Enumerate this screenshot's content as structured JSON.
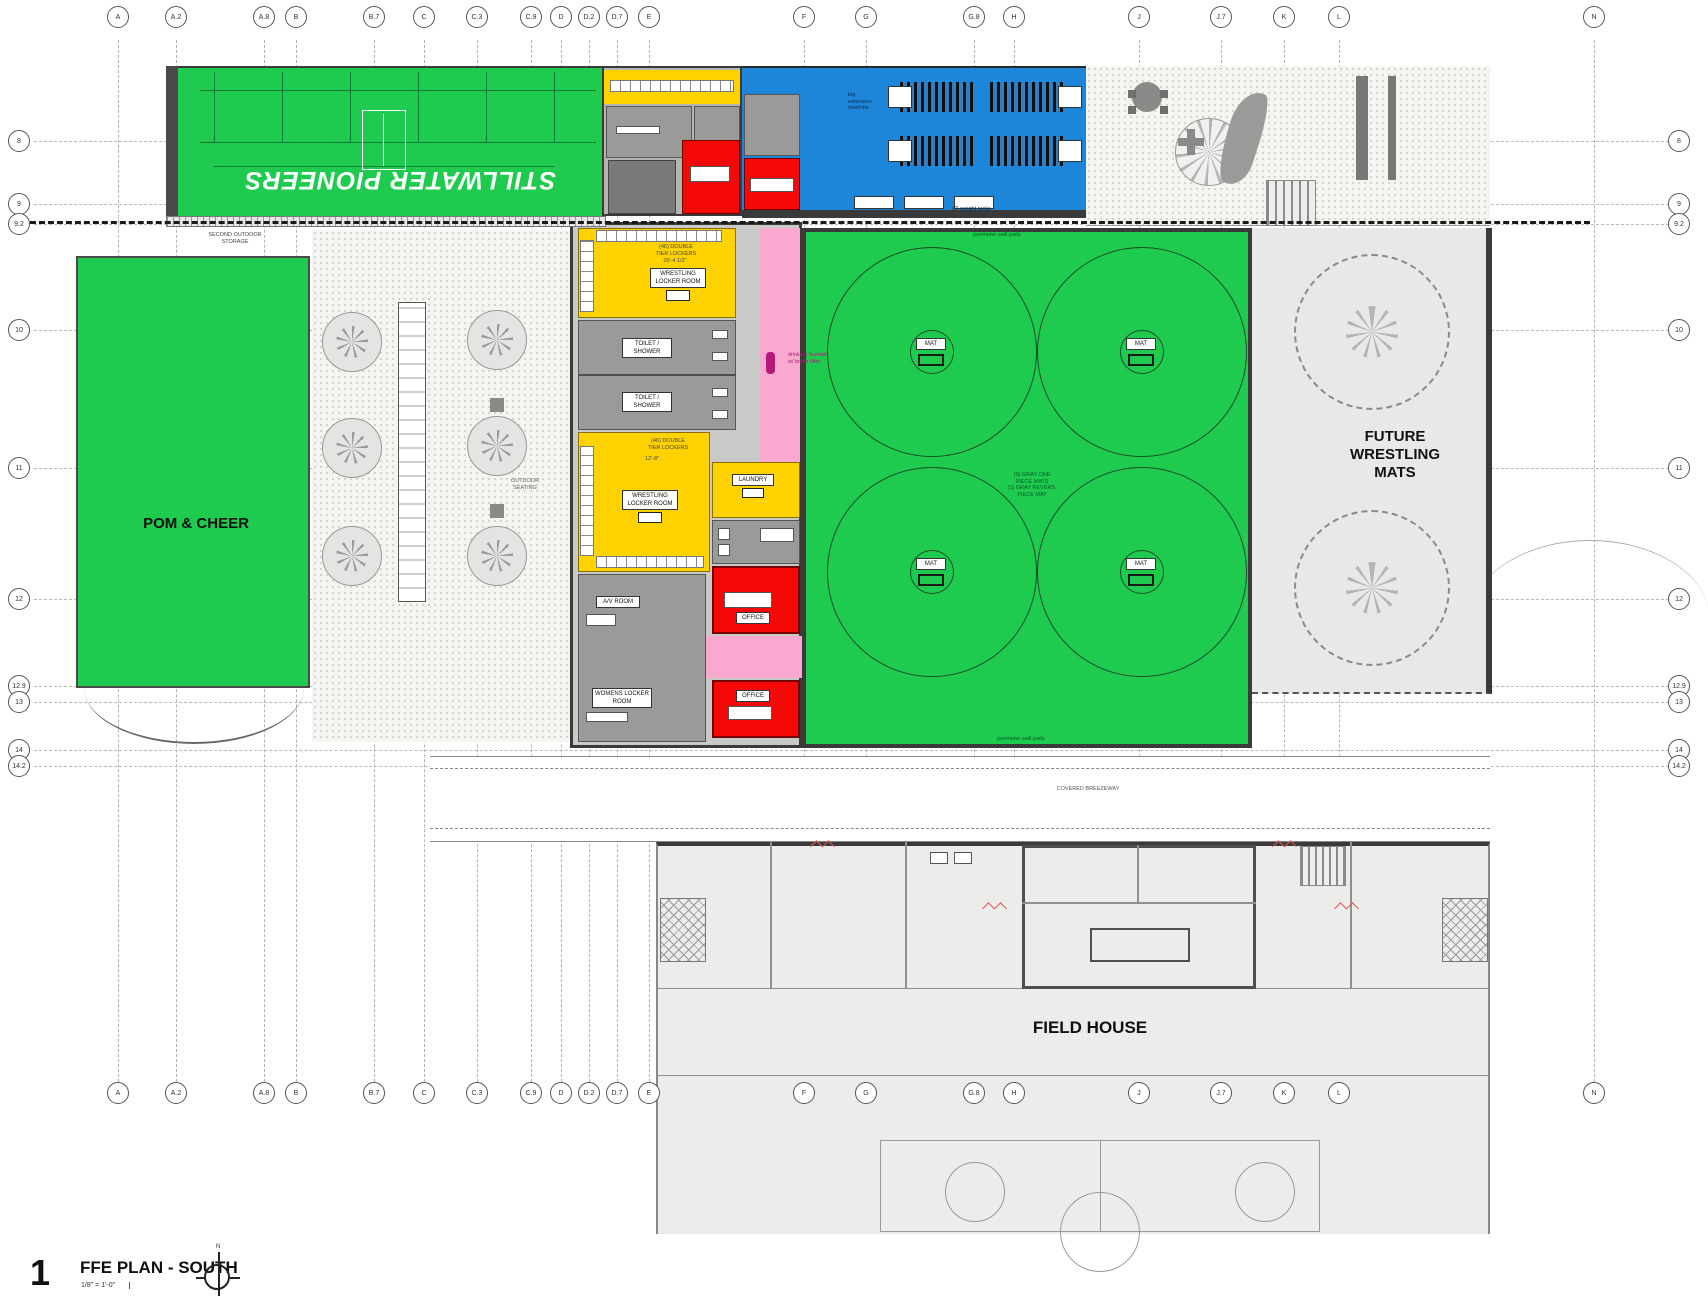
{
  "title_block": {
    "number": "1",
    "title": "FFE PLAN - SOUTH",
    "scale": "1/8\" = 1'-0\"",
    "north": "N"
  },
  "colors": {
    "green": "#1ECB4F",
    "blue": "#1E86D8",
    "yellow": "#FFD200",
    "red": "#F40808",
    "pink": "#F9A8D0",
    "gray_room": "#9A9A98",
    "light_gray": "#ECECEA",
    "wall": "#3A3A3A",
    "court_line": "#0B7A33"
  },
  "grid": {
    "columns": [
      [
        "A",
        118
      ],
      [
        "A.2",
        176
      ],
      [
        "A.8",
        264
      ],
      [
        "B",
        296
      ],
      [
        "B.7",
        374
      ],
      [
        "C",
        424
      ],
      [
        "C.3",
        477
      ],
      [
        "C.9",
        531
      ],
      [
        "D",
        561
      ],
      [
        "D.2",
        589
      ],
      [
        "D.7",
        617
      ],
      [
        "E",
        649
      ],
      [
        "F",
        804
      ],
      [
        "G",
        866
      ],
      [
        "G.8",
        974
      ],
      [
        "H",
        1014
      ],
      [
        "J",
        1139
      ],
      [
        "J.7",
        1221
      ],
      [
        "K",
        1284
      ],
      [
        "L",
        1339
      ],
      [
        "N",
        1594
      ]
    ],
    "rows": [
      [
        "8",
        141
      ],
      [
        "9",
        204
      ],
      [
        "9.2",
        224
      ],
      [
        "10",
        330
      ],
      [
        "11",
        468
      ],
      [
        "12",
        599
      ],
      [
        "12.9",
        686
      ],
      [
        "13",
        702
      ],
      [
        "14",
        750
      ],
      [
        "14.2",
        766
      ]
    ]
  },
  "rooms": {
    "turf": "STILLWATER PIONEERS",
    "pom": "POM & CHEER",
    "future": "FUTURE WRESTLING MATS",
    "field_house": "FIELD HOUSE",
    "breezeway": "COVERED BREEZEWAY",
    "wrestling_locker_1": "WRESTLING\nLOCKER ROOM",
    "wrestling_locker_2": "WRESTLING\nLOCKER ROOM",
    "laundry": "LAUNDRY",
    "womens_locker": "WOMENS LOCKER\nROOM",
    "av_room": "A/V ROOM",
    "office": "OFFICE",
    "toilet": "TOILET /\nSHOWER",
    "mat": "MAT"
  },
  "annotations": {
    "second_outdoor_storage": "SECOND OUTDOOR\nSTORAGE",
    "outdoor_seating": "OUTDOOR\nSEATING",
    "drinking_fountain": "drinking fountain\nw/ bottle filler",
    "lockers_note_1": "(46) DOUBLE\nTIER LOCKERS",
    "dim_1": "20'-4 1/2\"",
    "lockers_note_2": "(46) DOUBLE\nTIER LOCKERS",
    "dim_2": "12'-8\"",
    "mats_note": "(5) GRAY ONE\nPIECE MATS\n(1) GRAY REVERS.\nPIECE MAT",
    "wall_pads_top": "perimeter wall pads",
    "wall_pads_bottom": "perimeter wall pads",
    "leg_extension": "leg\nextension\nmachine",
    "weight_racks": "(2) weight racks"
  }
}
